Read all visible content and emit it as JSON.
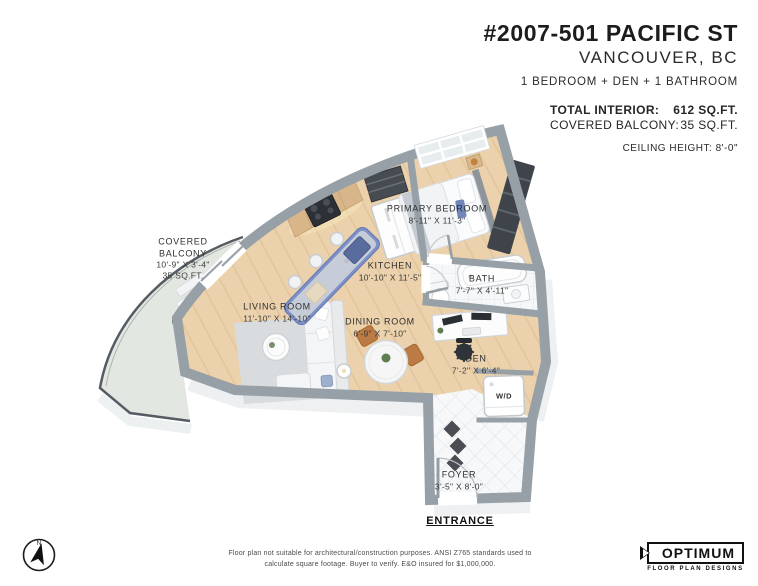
{
  "header": {
    "title": "#2007-501 PACIFIC ST",
    "city": "VANCOUVER, BC",
    "configuration": "1 BEDROOM + DEN + 1 BATHROOM",
    "total_interior_label": "TOTAL INTERIOR:",
    "total_interior_value": "612 SQ.FT.",
    "covered_balcony_label": "COVERED BALCONY:",
    "covered_balcony_value": "35 SQ.FT.",
    "ceiling_height": "CEILING HEIGHT: 8'-0\""
  },
  "rooms": {
    "covered_balcony": {
      "name": "COVERED BALCONY",
      "dims": "10'-9\" X 3'-4\"",
      "area": "35 SQ.FT."
    },
    "living_room": {
      "name": "LIVING ROOM",
      "dims": "11'-10\" X 14'-10\""
    },
    "dining_room": {
      "name": "DINING ROOM",
      "dims": "6'-9\" X 7'-10\""
    },
    "kitchen": {
      "name": "KITCHEN",
      "dims": "10'-10\" X 11'-5\""
    },
    "primary_bedroom": {
      "name": "PRIMARY BEDROOM",
      "dims": "8'-11\" X 11'-3\""
    },
    "bath": {
      "name": "BATH",
      "dims": "7'-7\" X 4'-11\""
    },
    "den": {
      "name": "DEN",
      "dims": "7'-2\" X 6'-4\""
    },
    "foyer": {
      "name": "FOYER",
      "dims": "3'-5\" X 8'-0\""
    }
  },
  "plan_labels": {
    "washer_dryer": "W/D",
    "entrance": "ENTRANCE",
    "compass_north": "N"
  },
  "footer": {
    "disclaimer_line1": "Floor plan not suitable for architectural/construction purposes. ANSI Z765 standards used to",
    "disclaimer_line2": "calculate square footage. Buyer to verify.  E&O insured for $1,000,000.",
    "logo_title": "OPTIMUM",
    "logo_subtitle": "FLOOR PLAN DESIGNS"
  },
  "colors": {
    "text": "#262626",
    "wall": "#97a0a7",
    "wood_floor": "#ebd2ac",
    "balcony_floor": "#e3e7e2",
    "island_accent": "#7d90c7",
    "cabinet_tan": "#d8b68a",
    "closet_dark": "#41464c",
    "tile_line": "#dde1e5",
    "diamond_accent": "#4a4e54"
  }
}
